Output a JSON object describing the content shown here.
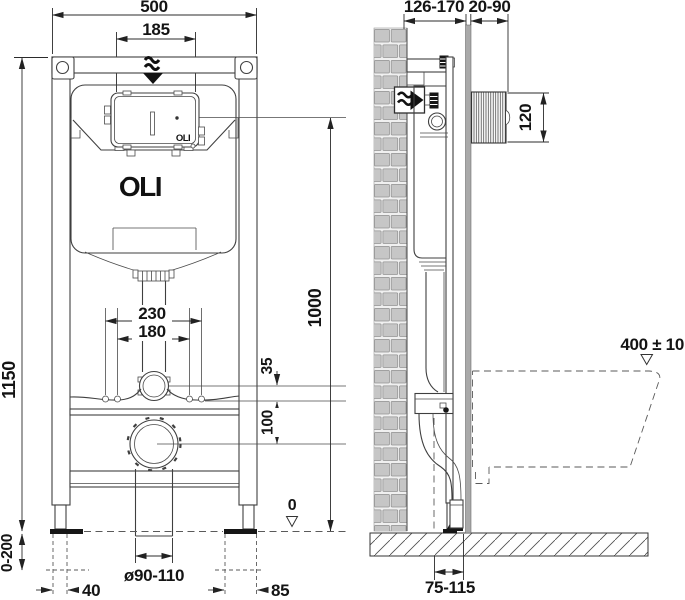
{
  "drawing": {
    "brand_logo": "OLI",
    "panel_logo": "OLI",
    "front": {
      "overall_width": "500",
      "inspection_opening_width": "185",
      "frame_height": "1150",
      "fixing_spacing_outer": "230",
      "fixing_spacing_inner": "180",
      "flush_bend_offset": "35",
      "drain_offset": "100",
      "leg_adjustment_range": "0-200",
      "left_offset": "40",
      "drain_pipe_diameter": "ø90-110",
      "right_offset": "85",
      "panel_centre_height": "1000",
      "floor_level": "0"
    },
    "side": {
      "frame_depth": "126-170",
      "wall_finish_thickness": "20-90",
      "flush_plate_height": "120",
      "bowl_rim_height": "400 ± 10",
      "outlet_distance": "75-115"
    }
  }
}
